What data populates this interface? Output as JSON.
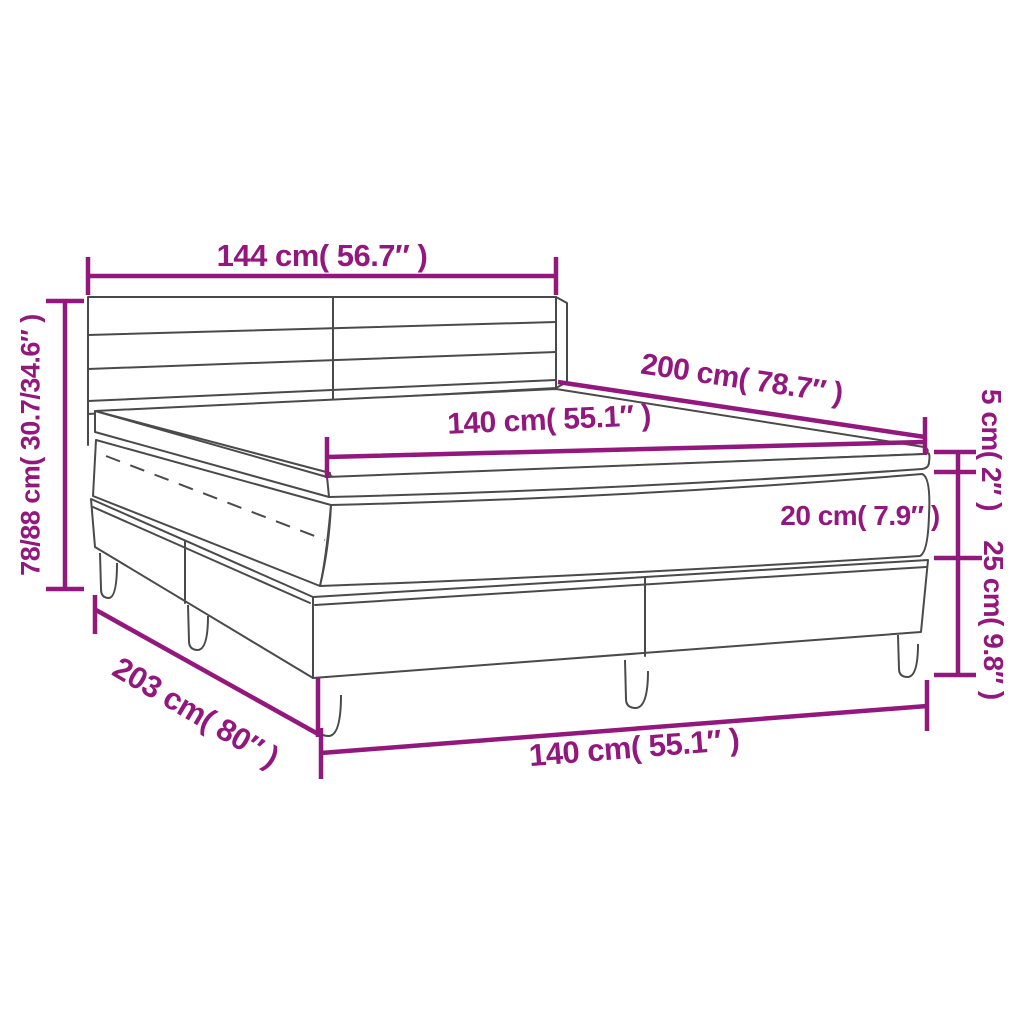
{
  "diagram": {
    "type": "product-dimension-diagram",
    "subject": "box spring bed with headboard, mattress topper, mattress and slatted base on legs",
    "accent_color": "#92187E",
    "line_color": "#4A4A4A",
    "background_color": "#FFFFFF",
    "labels": {
      "headboard_width": "144 cm( 56.7″ )",
      "overall_height": "78/88 cm( 30.7/34.6″ )",
      "mattress_length": "200 cm( 78.7″ )",
      "mattress_width": "140 cm( 55.1″ )",
      "topper_thickness": "5 cm( 2″ )",
      "mattress_thickness": "20 cm( 7.9″ )",
      "base_height": "25 cm( 9.8″ )",
      "base_length": "203 cm( 80″ )",
      "base_width": "140 cm( 55.1″ )"
    }
  }
}
